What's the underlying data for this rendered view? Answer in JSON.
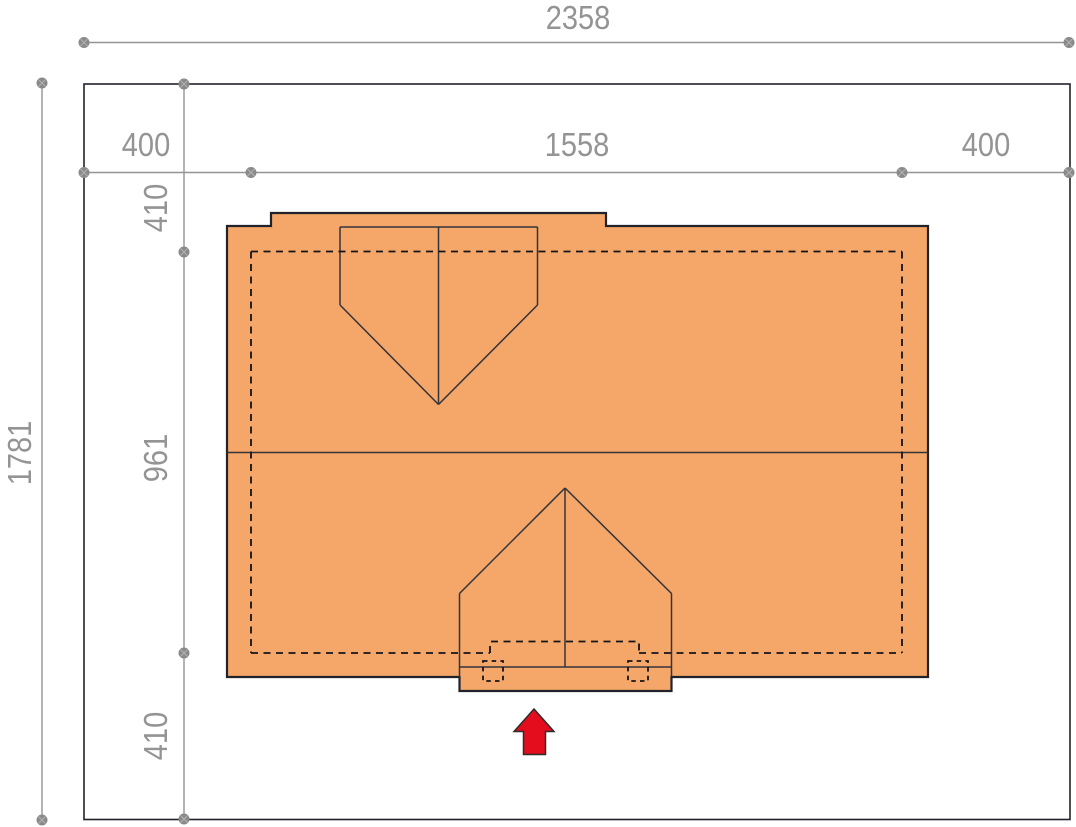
{
  "dimension_labels": {
    "total_width": "2358",
    "total_height": "1781",
    "horizontal_segments": [
      "400",
      "1558",
      "400"
    ],
    "vertical_segments": [
      "410",
      "961",
      "410"
    ]
  },
  "icons": {
    "entrance_arrow": "up-arrow"
  },
  "colors": {
    "roof_fill": "#f4a768",
    "arrow_fill": "#e30d1d",
    "dimension_gray": "#949494",
    "marker_gray": "#8a8a8a",
    "outline_dark": "#22222a",
    "plot_background": "#ffffff"
  }
}
